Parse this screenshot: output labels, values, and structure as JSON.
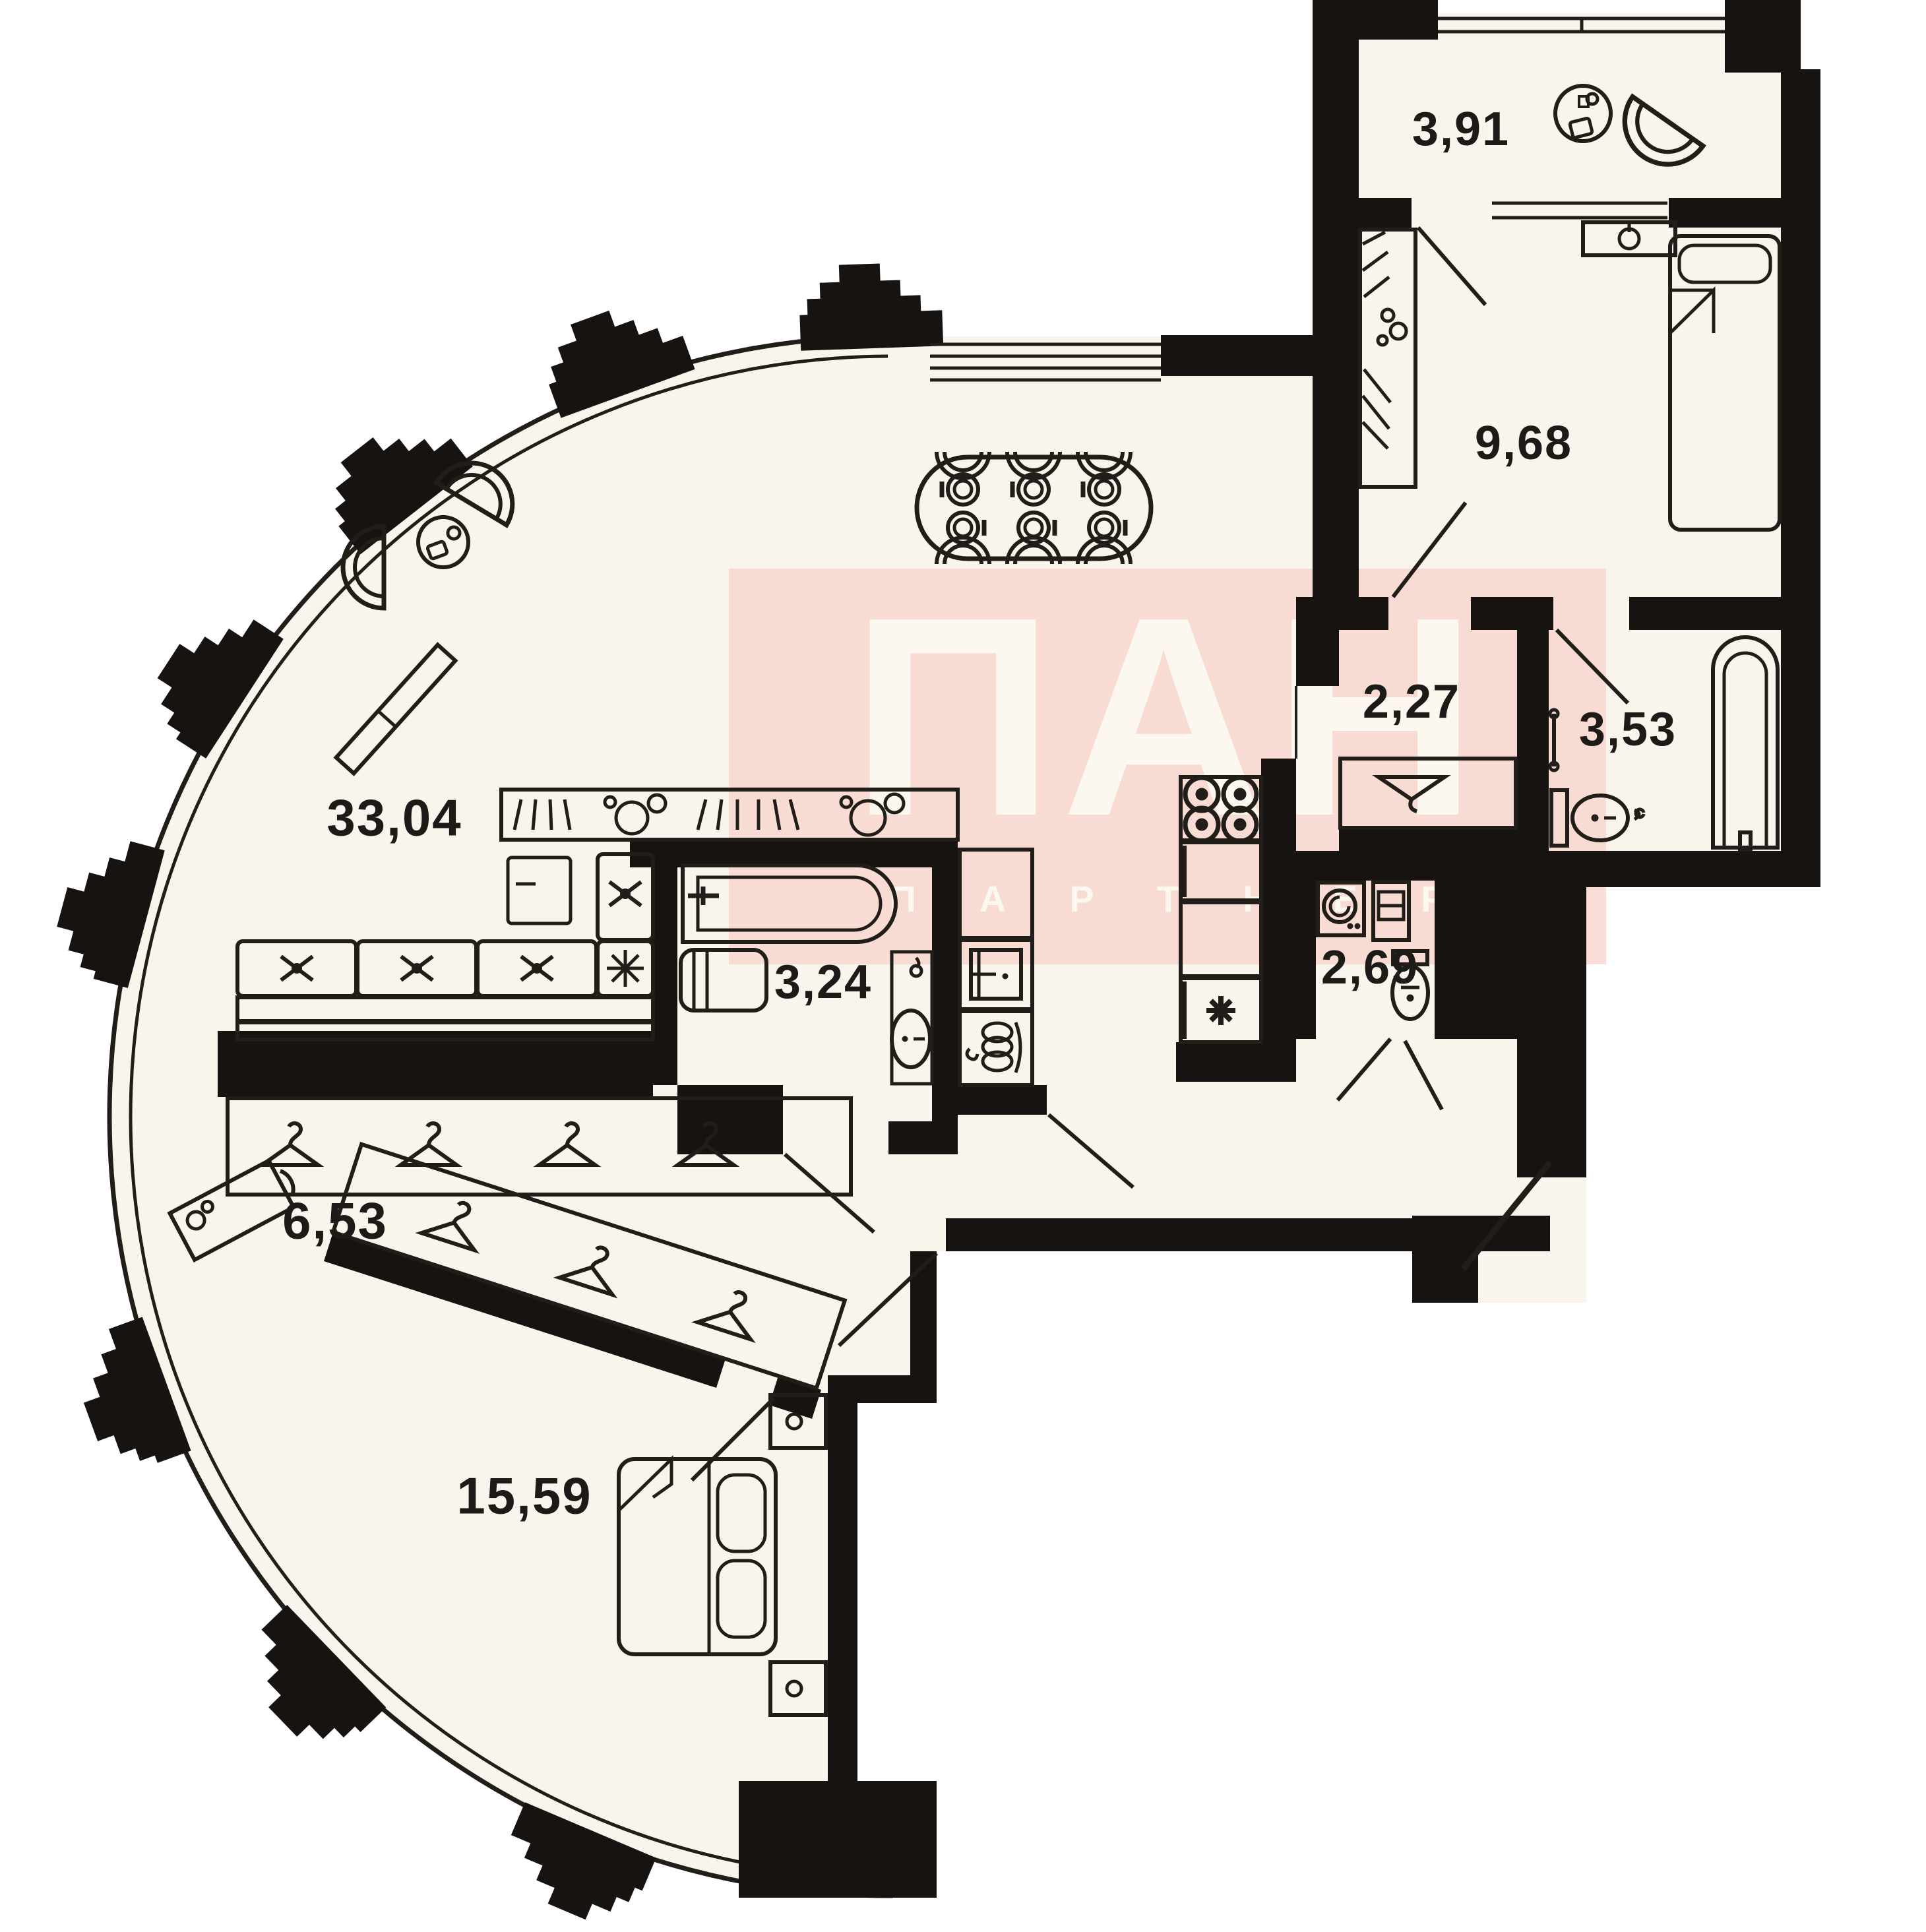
{
  "plan_title": "Apartment floor plan",
  "watermark": {
    "brand": "ПАН",
    "subbrand": "ПАРТНЕР",
    "color": "#f8d6cd"
  },
  "rooms": [
    {
      "id": "balcony",
      "name": "balcony",
      "area": "3,91"
    },
    {
      "id": "bedroom2",
      "name": "bedroom",
      "area": "9,68"
    },
    {
      "id": "laundry",
      "name": "corridor",
      "area": "2,27"
    },
    {
      "id": "bathroom2",
      "name": "bathroom",
      "area": "3,53"
    },
    {
      "id": "livingroom",
      "name": "living-kitchen",
      "area": "33,04"
    },
    {
      "id": "bathroom1",
      "name": "bathroom",
      "area": "3,24"
    },
    {
      "id": "wc",
      "name": "wc",
      "area": "2,69"
    },
    {
      "id": "dressing",
      "name": "dressing-room",
      "area": "6,53"
    },
    {
      "id": "bedroom1",
      "name": "bedroom",
      "area": "15,59"
    }
  ],
  "icons": [
    "washing-machine-icon",
    "armchair-icon",
    "coffee-table-icon",
    "dining-table-icon",
    "plate-icon",
    "chair-icon",
    "sofa-icon",
    "kitchen-sink-icon",
    "bathtub-icon",
    "toilet-icon",
    "wash-basin-icon",
    "boiler-icon",
    "stove-icon",
    "fridge-snowflake-icon",
    "laundry-sink-icon",
    "bed-icon",
    "pillow-icon",
    "nightstand-icon",
    "hanger-icon",
    "wardrobe-icon",
    "dressing-table-icon",
    "door-leaf-icon",
    "window-icon",
    "towel-rail-icon"
  ],
  "colors": {
    "floor": "#faf5ec",
    "walls": "#171310",
    "lines": "#211e1a",
    "watermark_pink": "#f8d6cd",
    "watermark_text": "#fdf8f0",
    "background": "#ffffff"
  }
}
